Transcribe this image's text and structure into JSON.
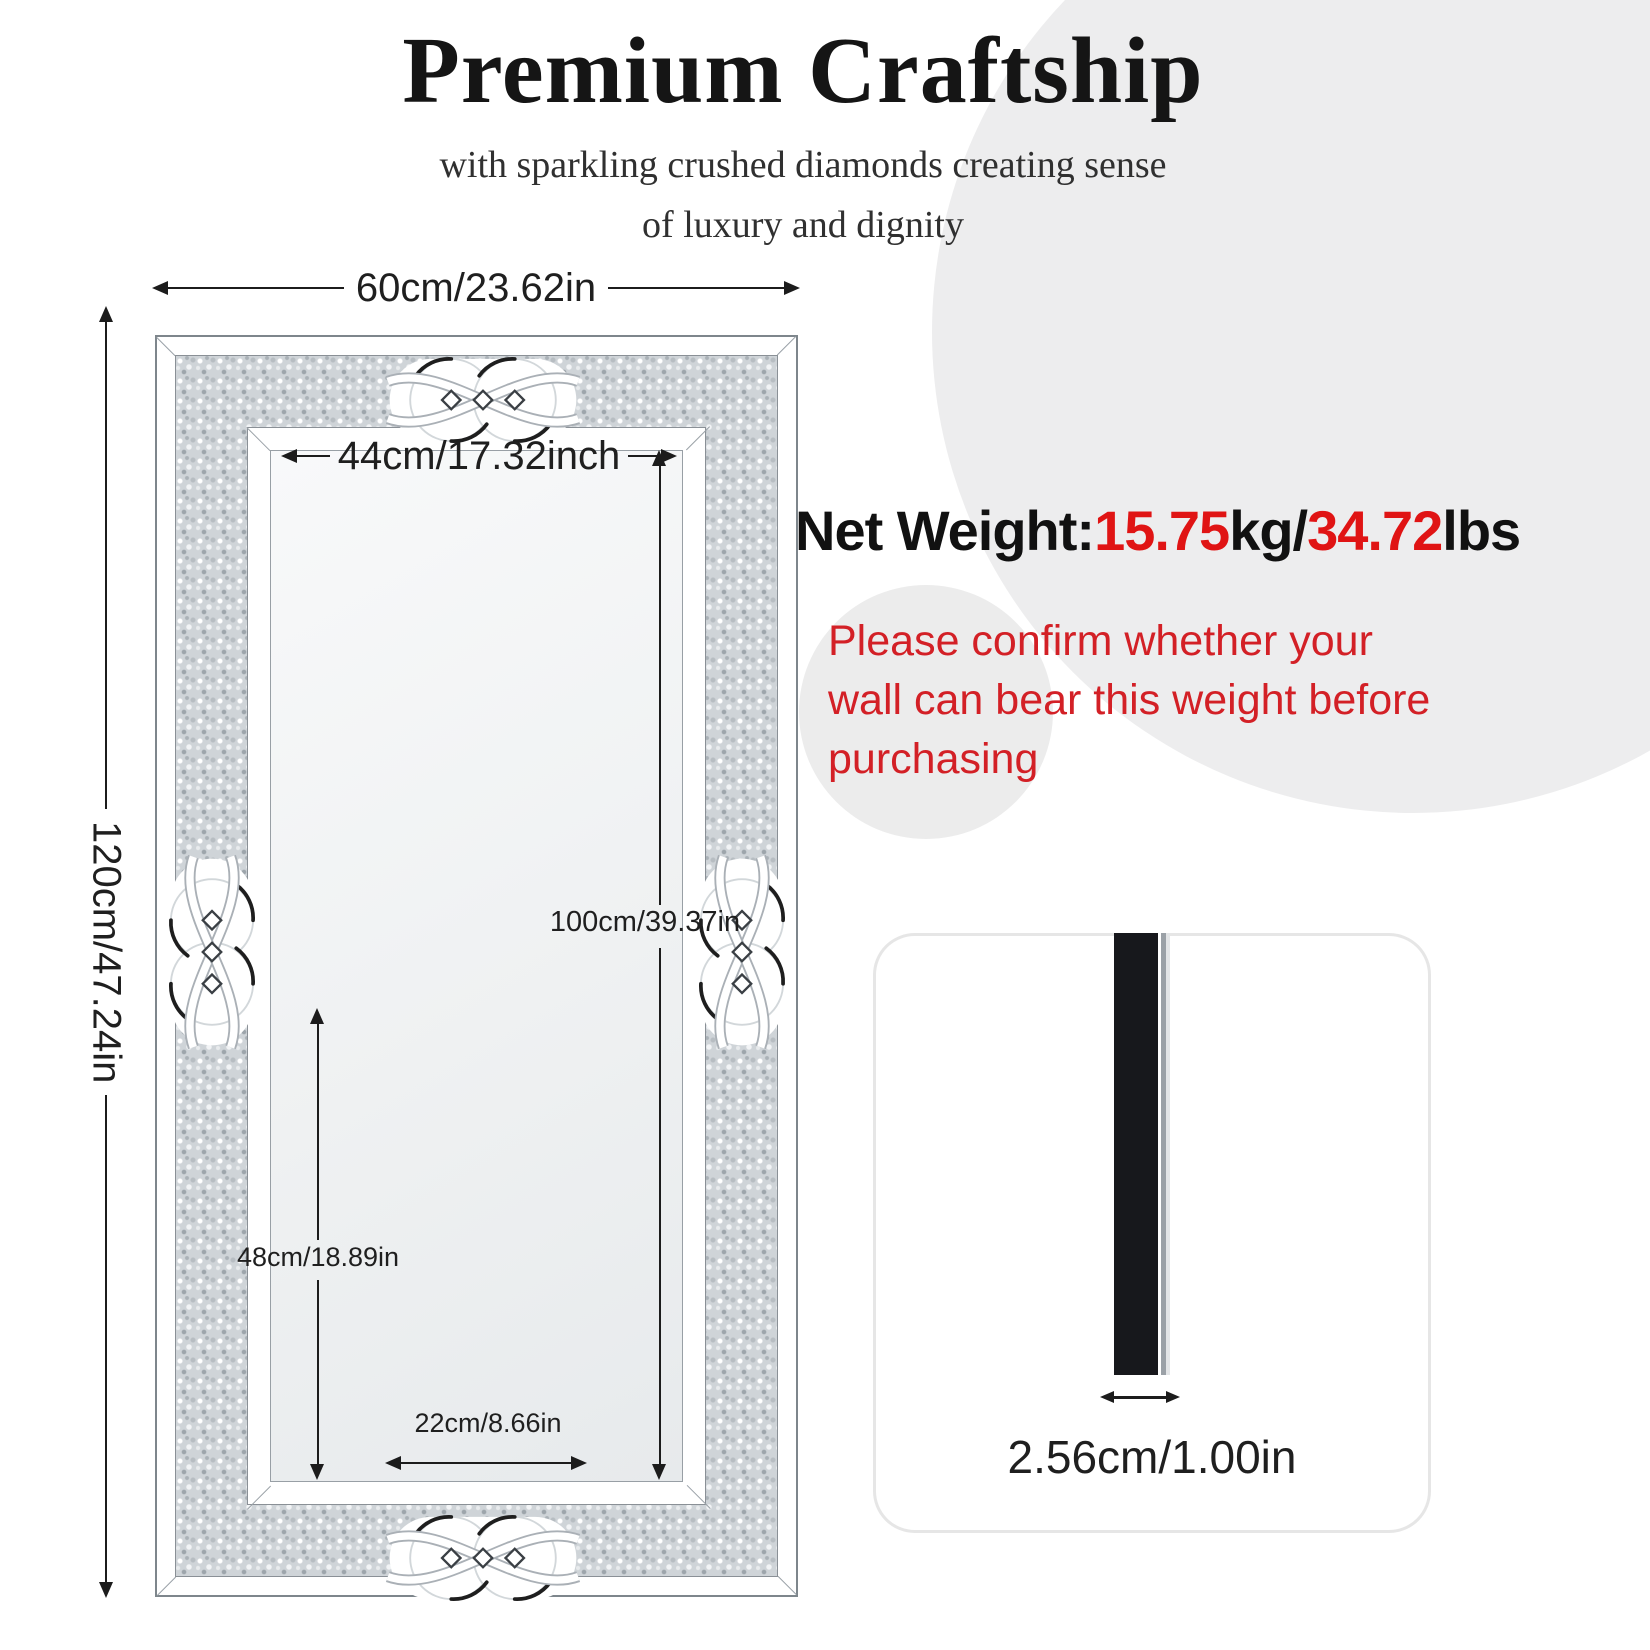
{
  "header": {
    "title": "Premium Craftship",
    "subtitle_line1": "with sparkling crushed diamonds creating sense",
    "subtitle_line2": "of luxury and dignity"
  },
  "weight": {
    "label": "Net Weight:",
    "kg_value": "15.75",
    "kg_unit": "kg/",
    "lbs_value": "34.72",
    "lbs_unit": "lbs"
  },
  "warning": {
    "line1": "Please confirm whether your",
    "line2": "wall can bear this weight before",
    "line3": "purchasing"
  },
  "dimensions": {
    "overall_width": "60cm/23.62in",
    "overall_height": "120cm/47.24in",
    "inner_width": "44cm/17.32inch",
    "inner_height": "100cm/39.37in",
    "lower_section_height": "48cm/18.89in",
    "bottom_gap_width": "22cm/8.66in",
    "thickness": "2.56cm/1.00in"
  },
  "colors": {
    "accent_red": "#e01414",
    "warning_red": "#d32026",
    "background_circle_gray": "#ededee",
    "dimension_line": "#1c1c1c"
  }
}
